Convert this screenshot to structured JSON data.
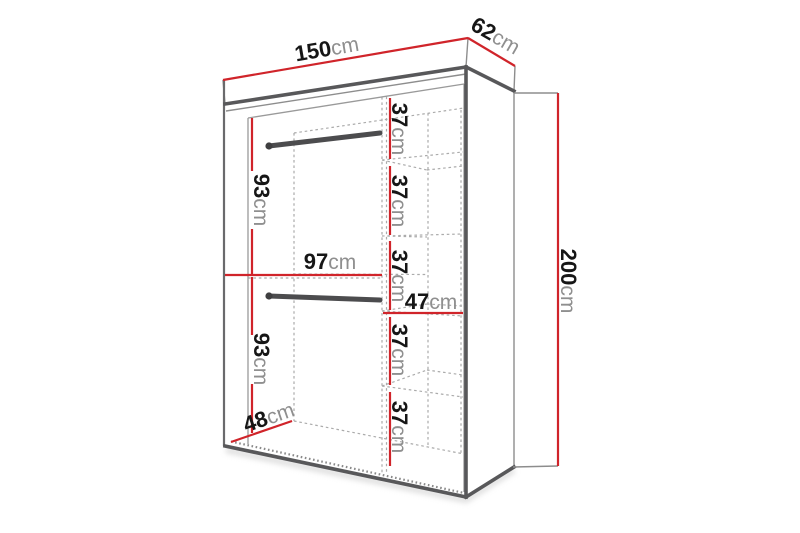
{
  "figure": {
    "type": "furniture-dimension-diagram",
    "subject": "wardrobe carcass in perspective with two hanging rails, a divider and five shelf compartments, annotated with red dimension lines"
  },
  "colors": {
    "dimension_line": "#d0242a",
    "edge_line": "#58585a",
    "hidden_edge_line": "#ababab",
    "value_text": "#161616",
    "unit_text": "#8f8f8f",
    "background": "#ffffff"
  },
  "dimensions": {
    "width": {
      "value": "150",
      "unit": "cm"
    },
    "depth": {
      "value": "62",
      "unit": "cm"
    },
    "height": {
      "value": "200",
      "unit": "cm"
    },
    "upper_rail_section_height": {
      "value": "93",
      "unit": "cm"
    },
    "lower_rail_section_height": {
      "value": "93",
      "unit": "cm"
    },
    "rail_compartment_width": {
      "value": "97",
      "unit": "cm"
    },
    "shelf_compartment_width": {
      "value": "47",
      "unit": "cm"
    },
    "interior_floor_depth": {
      "value": "48",
      "unit": "cm"
    },
    "shelf_gaps": [
      {
        "value": "37",
        "unit": "cm"
      },
      {
        "value": "37",
        "unit": "cm"
      },
      {
        "value": "37",
        "unit": "cm"
      },
      {
        "value": "37",
        "unit": "cm"
      },
      {
        "value": "37",
        "unit": "cm"
      }
    ]
  }
}
